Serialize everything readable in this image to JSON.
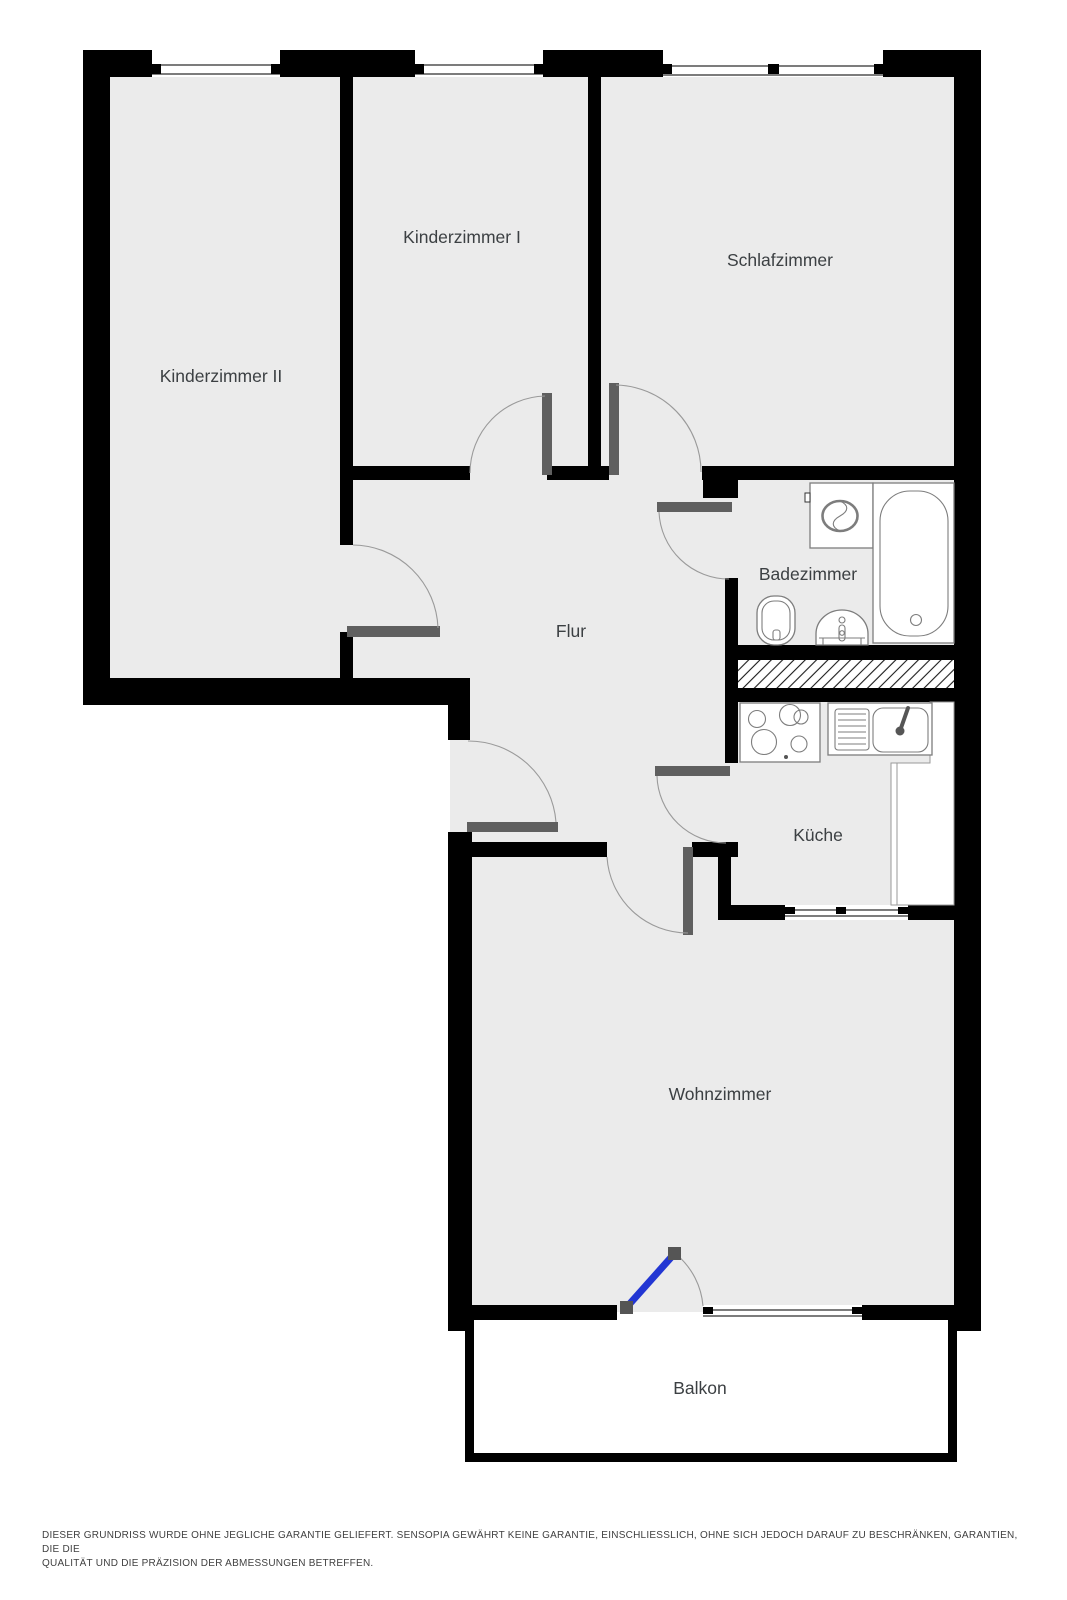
{
  "plan": {
    "rooms": [
      {
        "name": "Kinderzimmer II"
      },
      {
        "name": "Kinderzimmer I"
      },
      {
        "name": "Schlafzimmer"
      },
      {
        "name": "Badezimmer"
      },
      {
        "name": "Flur"
      },
      {
        "name": "Küche"
      },
      {
        "name": "Wohnzimmer"
      },
      {
        "name": "Balkon"
      }
    ],
    "fixtures": [
      "washing-machine",
      "bathtub",
      "toilet",
      "bathroom-sink",
      "stove",
      "kitchen-sink",
      "kitchen-counter"
    ],
    "colors": {
      "wall": "#000000",
      "floor": "#ebebeb",
      "door_leaf": "#5f5f5f",
      "balcony_door": "#2236d3",
      "swing_arc": "#9a9a9a",
      "fixture_outline": "#7d7d7d",
      "label_text": "#3c4043"
    },
    "disclaimer": {
      "line1": "DIESER GRUNDRISS WURDE OHNE JEGLICHE GARANTIE GELIEFERT. SENSOPIA GEWÄHRT KEINE GARANTIE, EINSCHLIESSLICH, OHNE SICH JEDOCH DARAUF ZU BESCHRÄNKEN, GARANTIEN, DIE DIE",
      "line2": "QUALITÄT UND DIE PRÄZISION DER ABMESSUNGEN BETREFFEN."
    }
  }
}
